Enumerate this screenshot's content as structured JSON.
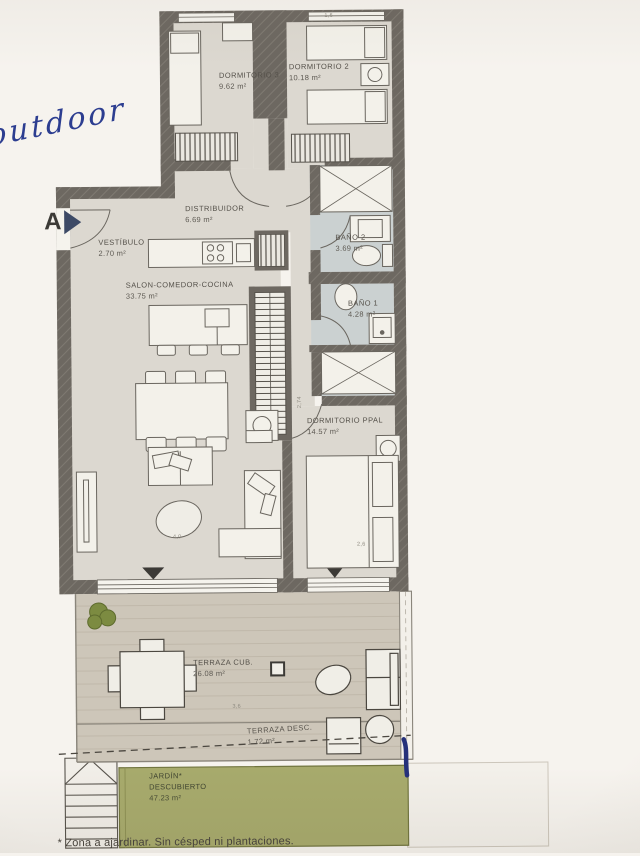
{
  "photo": {
    "handwritten_note": "outdoor",
    "section_marker": "A",
    "footnote": "* Zona a ajardinar. Sin césped ni plantaciones."
  },
  "colors": {
    "paper": "#f6f3ee",
    "wall": "#6d6861",
    "interior_floor": "#dcd8d0",
    "bath_floor": "#cbd1d1",
    "terrace_floor": "#cdc6b9",
    "garden_green": "#a7aa6c",
    "furniture_fill": "#f3f1ea",
    "line": "#6a665f",
    "ink_blue": "#2c3d90"
  },
  "rooms": {
    "dormitorio3": {
      "name": "DORMITORIO 3",
      "area": "9.62 m²"
    },
    "dormitorio2": {
      "name": "DORMITORIO 2",
      "area": "10.18 m²"
    },
    "distribuidor": {
      "name": "DISTRIBUIDOR",
      "area": "6.69 m²"
    },
    "vestibulo": {
      "name": "VESTÍBULO",
      "area": "2.70 m²"
    },
    "salon": {
      "name": "SALON-COMEDOR-COCINA",
      "area": "33.75 m²"
    },
    "bano2": {
      "name": "BAÑO 2",
      "area": "3.69 m²"
    },
    "bano1": {
      "name": "BAÑO 1",
      "area": "4.28 m²"
    },
    "dormitorio_ppal": {
      "name": "DORMITORIO PPAL",
      "area": "14.57 m²"
    },
    "terraza_cub": {
      "name": "TERRAZA CUB.",
      "area": "26.08 m²"
    },
    "terraza_desc": {
      "name": "TERRAZA DESC.",
      "area": "1.72 m²"
    },
    "jardin": {
      "name": "JARDÍN*",
      "name2": "DESCUBIERTO",
      "area": "47.23 m²"
    }
  },
  "dims": {
    "salon_w": "4,0",
    "dorm_w": "2,6",
    "terraza_w": "3,6",
    "salon_h": "2,74",
    "top_w": "1,6"
  }
}
